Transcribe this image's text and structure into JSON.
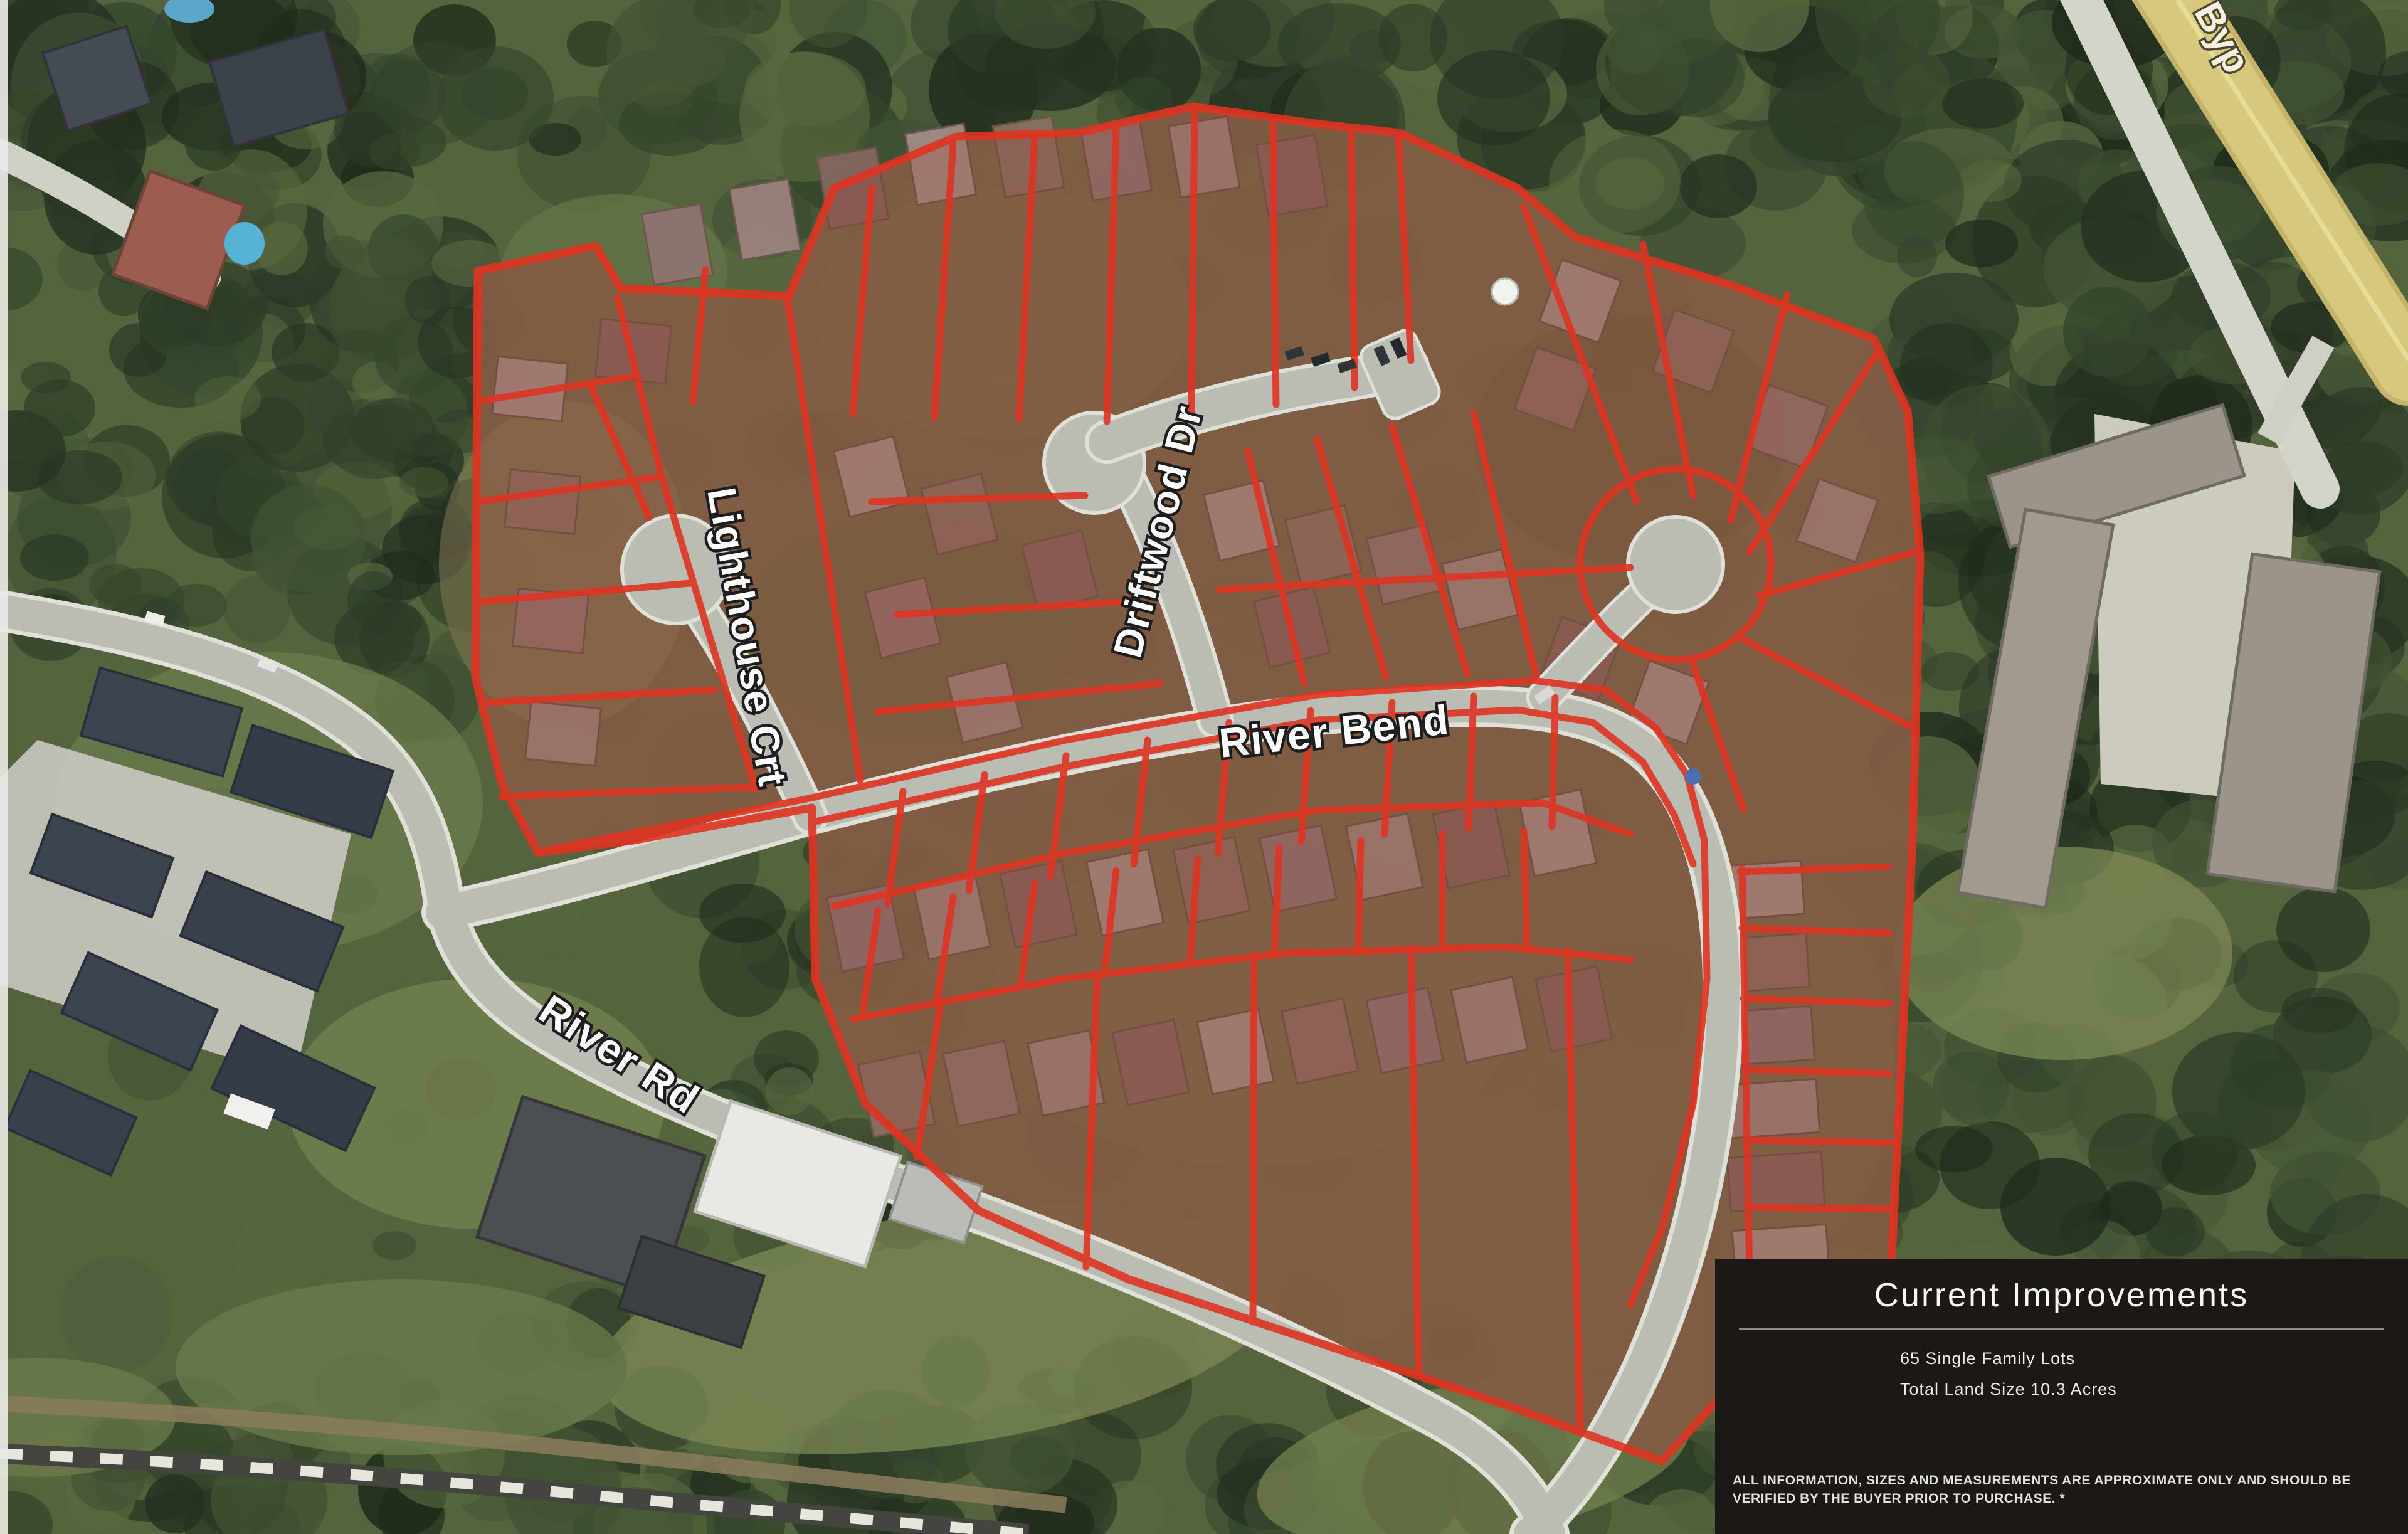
{
  "map": {
    "street_labels": [
      {
        "id": "lighthouse",
        "name": "Lighthouse Crt"
      },
      {
        "id": "driftwood",
        "name": "Driftwood Dr"
      },
      {
        "id": "riverbend",
        "name": "River Bend"
      },
      {
        "id": "riverrd",
        "name": "River Rd"
      },
      {
        "id": "bypass",
        "name": "Byp"
      }
    ]
  },
  "panel": {
    "title": "Current Improvements",
    "stats": [
      "65 Single Family Lots",
      "Total Land Size 10.3 Acres"
    ],
    "disclaimer": "ALL INFORMATION, SIZES AND MEASUREMENTS ARE APPROXIMATE ONLY AND SHOULD BE VERIFIED BY THE BUYER PRIOR TO PURCHASE. *"
  },
  "colors": {
    "lot_outline": "#df3422",
    "lot_tint": "#a52316",
    "road_gray": "#b9bdb3",
    "road_casing": "#dfe0d8",
    "highway_yellow": "#d8c87c",
    "forest_dark": "#2e3c27",
    "panel_bg": "#1b1816",
    "panel_text": "#f2f2f0",
    "label_fill": "#ffffff"
  }
}
